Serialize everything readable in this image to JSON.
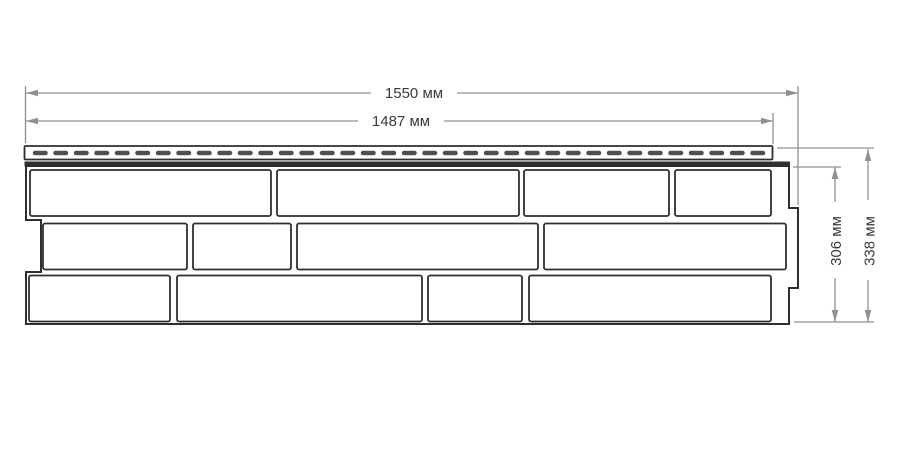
{
  "colors": {
    "background": "#ffffff",
    "line": "#2f2f2f",
    "slot": "#4f4f4f",
    "dim": "#909090",
    "text": "#3a3a3a"
  },
  "dimensions": {
    "width_outer": {
      "label": "1550 мм",
      "value": 1550,
      "unit": "мм"
    },
    "width_inner": {
      "label": "1487 мм",
      "value": 1487,
      "unit": "мм"
    },
    "height_inner": {
      "label": "306 мм",
      "value": 306,
      "unit": "мм"
    },
    "height_outer": {
      "label": "338 мм",
      "value": 338,
      "unit": "мм"
    }
  }
}
